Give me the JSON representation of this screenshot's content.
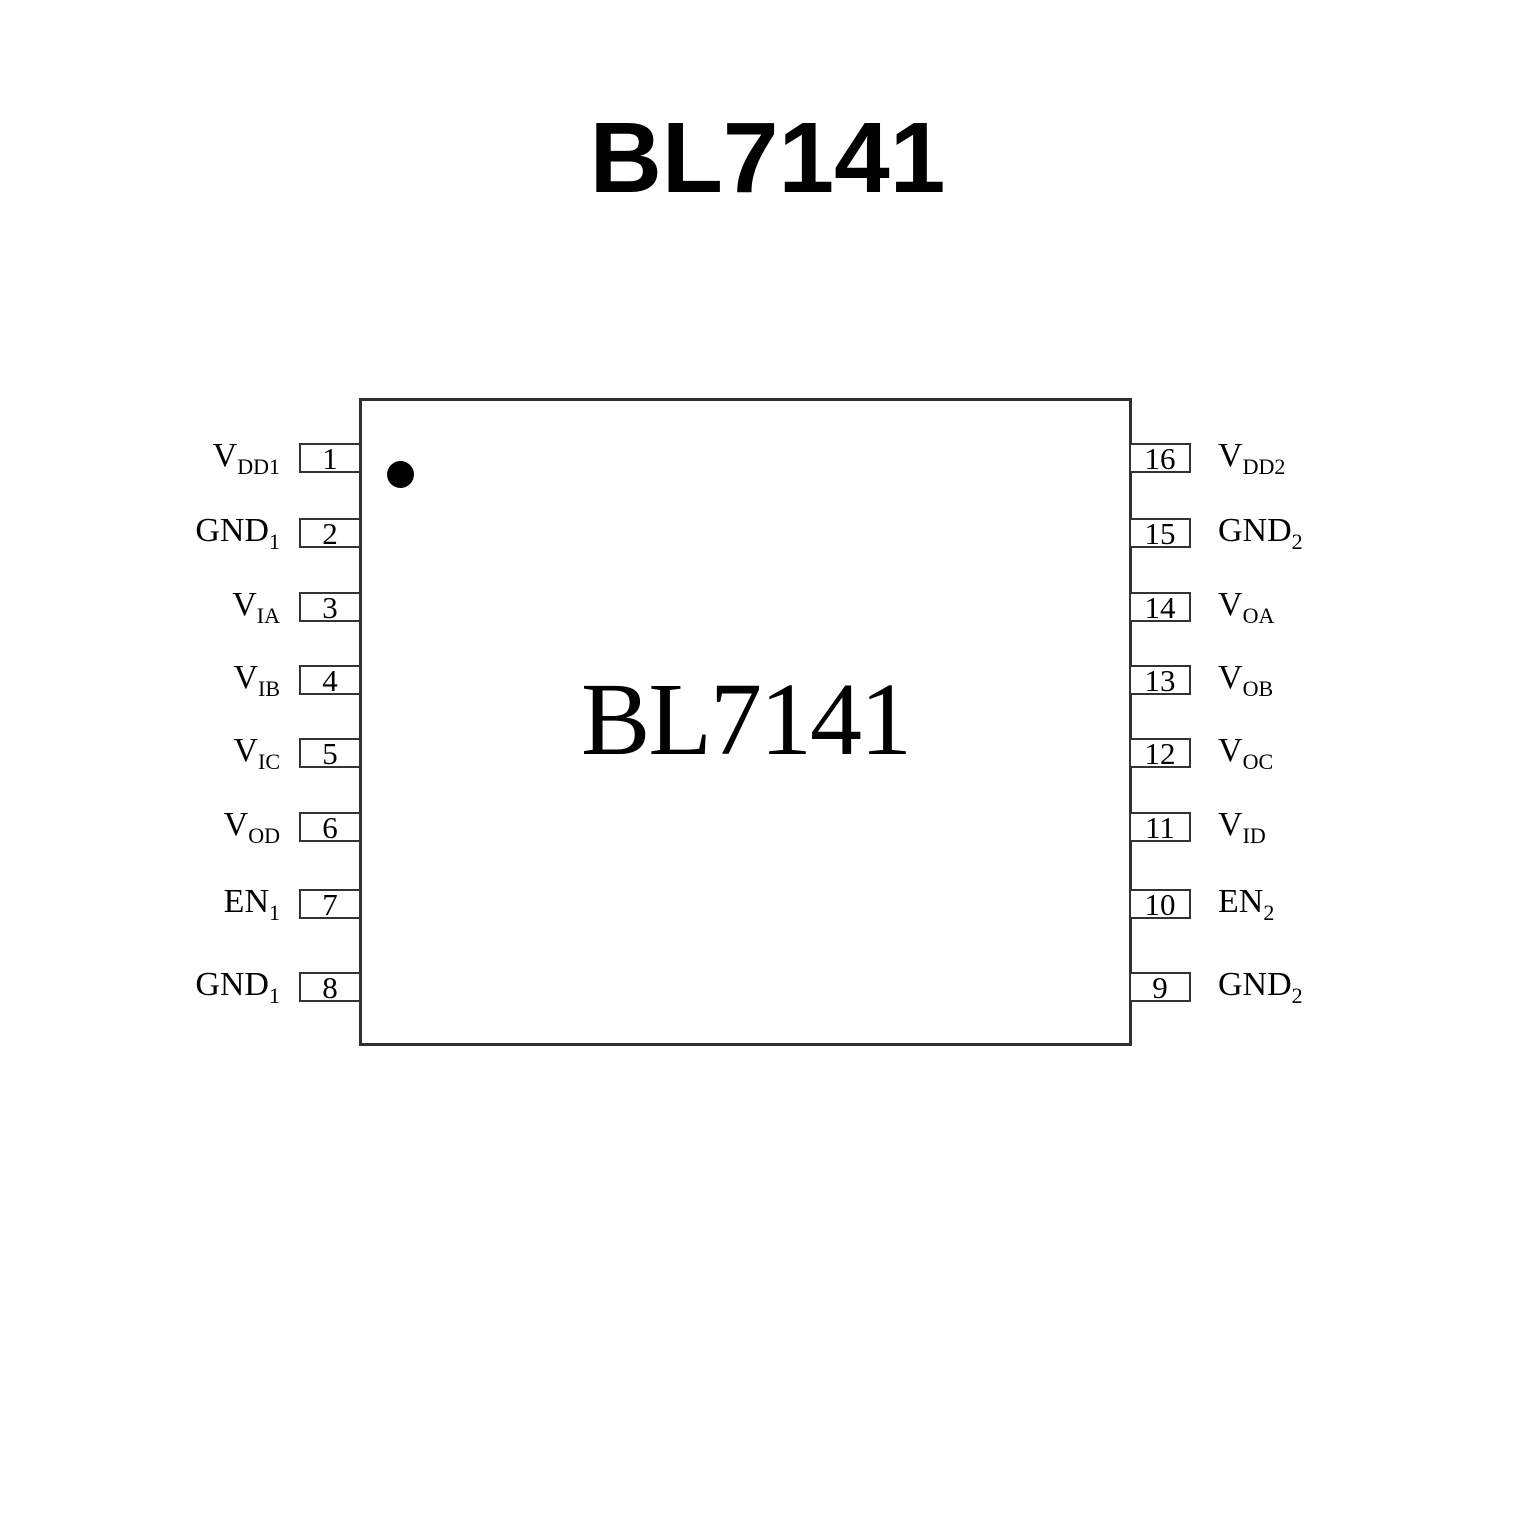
{
  "page_title": "BL7141",
  "chip": {
    "label": "BL7141"
  },
  "icons": {
    "pin1_indicator": "filled-circle"
  },
  "pins": {
    "left": [
      {
        "num": "1",
        "main": "V",
        "sub": "DD1"
      },
      {
        "num": "2",
        "main": "GND",
        "sub": "1"
      },
      {
        "num": "3",
        "main": "V",
        "sub": "IA"
      },
      {
        "num": "4",
        "main": "V",
        "sub": "IB"
      },
      {
        "num": "5",
        "main": "V",
        "sub": "IC"
      },
      {
        "num": "6",
        "main": "V",
        "sub": "OD"
      },
      {
        "num": "7",
        "main": "EN",
        "sub": "1"
      },
      {
        "num": "8",
        "main": "GND",
        "sub": "1"
      }
    ],
    "right": [
      {
        "num": "16",
        "main": "V",
        "sub": "DD2"
      },
      {
        "num": "15",
        "main": "GND",
        "sub": "2"
      },
      {
        "num": "14",
        "main": "V",
        "sub": "OA"
      },
      {
        "num": "13",
        "main": "V",
        "sub": "OB"
      },
      {
        "num": "12",
        "main": "V",
        "sub": "OC"
      },
      {
        "num": "11",
        "main": "V",
        "sub": "ID"
      },
      {
        "num": "10",
        "main": "EN",
        "sub": "2"
      },
      {
        "num": "9",
        "main": "GND",
        "sub": "2"
      }
    ]
  },
  "colors": {
    "ink": "#000000",
    "border": "#333333",
    "background": "#ffffff"
  }
}
